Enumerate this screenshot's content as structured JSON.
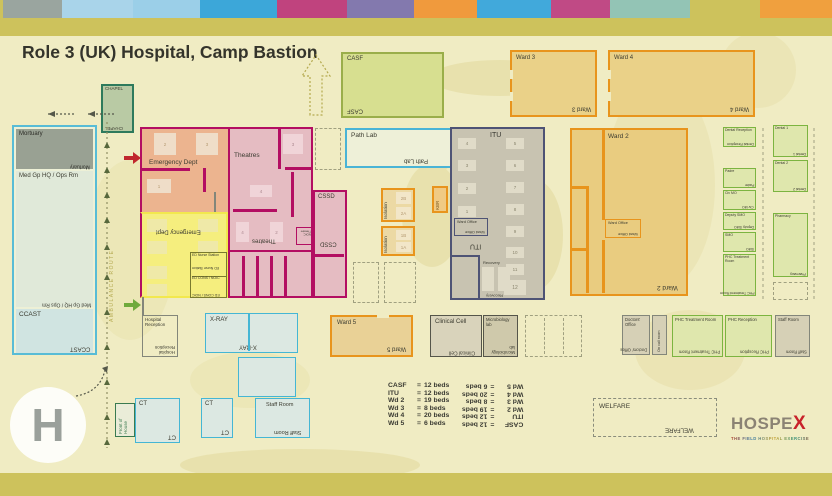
{
  "title": "Role 3 (UK) Hospital, Camp Bastion",
  "topbar": {
    "segments": [
      {
        "color": "#cdc25c",
        "w": 3
      },
      {
        "color": "#9aa59f",
        "w": 59
      },
      {
        "color": "#a9d4ea",
        "w": 71
      },
      {
        "color": "#9bcfe8",
        "w": 67
      },
      {
        "color": "#3ca7d9",
        "w": 77
      },
      {
        "color": "#c0437e",
        "w": 70
      },
      {
        "color": "#8379ae",
        "w": 67
      },
      {
        "color": "#f09a3d",
        "w": 63
      },
      {
        "color": "#41a9db",
        "w": 74
      },
      {
        "color": "#c04a85",
        "w": 59
      },
      {
        "color": "#93c4b5",
        "w": 80
      },
      {
        "color": "#cdc25c",
        "w": 70
      },
      {
        "color": "#f0a03e",
        "w": 72
      }
    ]
  },
  "route": {
    "ambulance": "AMBULANCE ROUTE"
  },
  "rooms": {
    "chapel": "CHAPEL",
    "casf": "CASF",
    "ward3": "Ward 3",
    "ward4": "Ward 4",
    "ward2": "Ward 2",
    "ward5": "Ward 5",
    "mortuary": "Mortuary",
    "med_gp": "Med Gp HQ / Ops Rm",
    "ccast": "CCAST",
    "emergency": "Emergency Dept",
    "ed_nurse": "ED Nurse Station",
    "ed_cons": "ED CONS / NOIC",
    "theatres": "Theatres",
    "noic_theatre": "NOIC Theatre",
    "cssd": "CSSD",
    "path_lab": "Path Lab",
    "isolation": "Isolation",
    "kbr": "KBR",
    "itu": "ITU",
    "ward_office": "Ward Office",
    "recovery": "Recovery",
    "dental_reception": "Dental Reception",
    "dental1": "Dental 1",
    "dental2": "Dental 2",
    "padre": "Padre",
    "civ_mo": "Civ MO",
    "deputy_smo": "Deputy SMO",
    "smo": "SMO",
    "phc_treatment": "PHC Treatment Room",
    "pharmacy": "Pharmacy",
    "hospital_reception": "Hospital Reception",
    "front_of_house": "Front of House",
    "xray": "X-RAY",
    "ct": "CT",
    "staff_room": "Staff Room",
    "clinical_cell": "Clinical Cell",
    "microbiology": "Microbiology lab",
    "doctors_office": "Doctors' Office",
    "on_call": "On call room",
    "phc_reception": "PHC Reception",
    "welfare": "WELFARE"
  },
  "iso_rooms": [
    "2B",
    "2A",
    "1B",
    "1A"
  ],
  "ed_bays": [
    "2",
    "3",
    "1"
  ],
  "theatre_bays": [
    "3",
    "4",
    "4",
    "2"
  ],
  "itu_beds": [
    "4",
    "3",
    "2",
    "1",
    "5",
    "6",
    "7",
    "8",
    "9",
    "10",
    "11",
    "12"
  ],
  "legend": {
    "eq": "=",
    "rows": [
      {
        "k": "CASF",
        "v": "12 beds"
      },
      {
        "k": "ITU",
        "v": "12 beds"
      },
      {
        "k": "Wd 2",
        "v": "19 beds"
      },
      {
        "k": "Wd 3",
        "v": "8 beds"
      },
      {
        "k": "Wd 4",
        "v": "20 beds"
      },
      {
        "k": "Wd 5",
        "v": "6 beds"
      }
    ]
  },
  "helipad": {
    "letter": "H"
  },
  "logo": {
    "word": "HOSPE",
    "x": "X",
    "subtitle": "THE FIELD HOSPITAL EXERCISE"
  }
}
